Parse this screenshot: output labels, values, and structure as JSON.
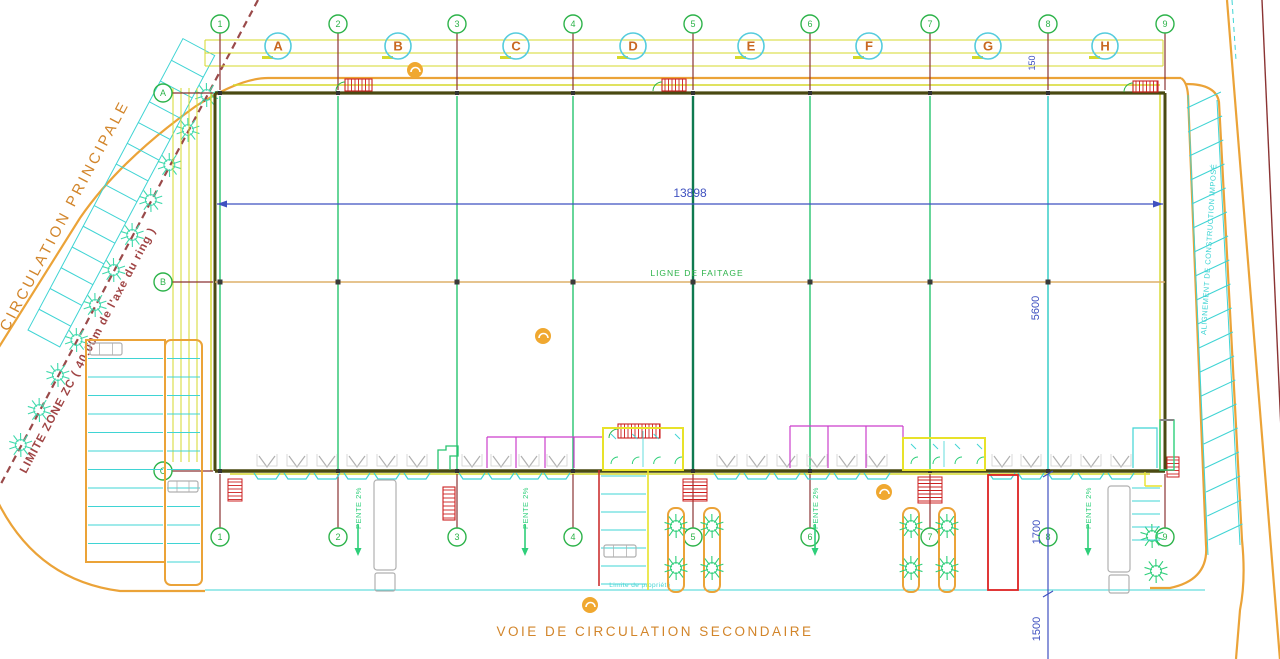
{
  "drawing": {
    "kind": "architectural-site-plan",
    "canvas": {
      "w": 1280,
      "h": 659
    }
  },
  "colors": {
    "green": "#2db34a",
    "col_green": "#27c46f",
    "col_dark": "#0f7a50",
    "cyan": "#3fd4d4",
    "cyan_circle": "#55ccdd",
    "teal_tree": "#3fd9ac",
    "green_tree": "#2ecf7a",
    "orange_road": "#eba338",
    "orange_text": "#d2852a",
    "orange_letter": "#c86820",
    "ridge": "#ddb06a",
    "yellow": "#d6d92b",
    "olive_wall": "#4a4a12",
    "maroon": "#9a4a4a",
    "dark_red": "#8a3333",
    "red": "#cc2020",
    "blue": "#3f51c0",
    "magenta": "#cc3fcc",
    "gray": "#b0b0b0",
    "orange_symbol": "#f0a830"
  },
  "grid": {
    "columns": [
      {
        "n": "1",
        "x": 220
      },
      {
        "n": "2",
        "x": 338
      },
      {
        "n": "3",
        "x": 457
      },
      {
        "n": "4",
        "x": 573
      },
      {
        "n": "5",
        "x": 693
      },
      {
        "n": "6",
        "x": 810
      },
      {
        "n": "7",
        "x": 930
      },
      {
        "n": "8",
        "x": 1048
      },
      {
        "n": "9",
        "x": 1165
      }
    ],
    "top_bubble_y": 24,
    "bottom_bubble_y": 537,
    "letters": [
      {
        "l": "A",
        "x": 278
      },
      {
        "l": "B",
        "x": 398
      },
      {
        "l": "C",
        "x": 516
      },
      {
        "l": "D",
        "x": 633
      },
      {
        "l": "E",
        "x": 751
      },
      {
        "l": "F",
        "x": 869
      },
      {
        "l": "G",
        "x": 988
      },
      {
        "l": "H",
        "x": 1105
      }
    ],
    "letter_y": 46,
    "rows": [
      {
        "l": "A",
        "y": 93
      },
      {
        "l": "B",
        "y": 282
      },
      {
        "l": "C",
        "y": 471
      }
    ],
    "row_bubble_x": 163
  },
  "building": {
    "x1": 215,
    "y1": 93,
    "x2": 1165,
    "y2": 471,
    "ridge_y": 282
  },
  "dimensions": {
    "width": {
      "label": "13898",
      "y": 204,
      "lx": 690,
      "ly": 197
    },
    "v5600": {
      "label": "5600",
      "x": 1048,
      "lx": 1039,
      "ly": 308
    },
    "v150": {
      "label": "150",
      "lx": 1035,
      "ly": 63
    },
    "v1700": {
      "label": "1700",
      "lx": 1040,
      "ly": 532,
      "y1": 474,
      "y2": 594
    },
    "v1500": {
      "label": "1500",
      "lx": 1040,
      "ly": 629,
      "y1": 594,
      "y2": 662
    }
  },
  "texts": {
    "ridge": "LIGNE DE FAITAGE",
    "road_secondary": "VOIE DE CIRCULATION SECONDAIRE",
    "road_principal": "CIRCULATION PRINCIPALE",
    "limite_zone": "LIMITE ZONE ZC ( 40.00m de l'axe du ring )",
    "alignement": "ALIGNEMENT DE CONSTRUCTION IMPOSÉ",
    "limite_propriete": "Limite de propriété",
    "pente": "PENTE 2%"
  },
  "pente_arrows": [
    {
      "x": 358
    },
    {
      "x": 525
    },
    {
      "x": 815
    },
    {
      "x": 1088
    }
  ],
  "docks": [
    267,
    297,
    327,
    357,
    387,
    417,
    472,
    501,
    529,
    557,
    727,
    757,
    787,
    817,
    847,
    877,
    1002,
    1031,
    1061,
    1091,
    1121
  ],
  "stairs_h": [
    {
      "x": 228,
      "y": 479,
      "w": 14,
      "h": 22
    },
    {
      "x": 683,
      "y": 479,
      "w": 24,
      "h": 22
    },
    {
      "x": 918,
      "y": 477,
      "w": 24,
      "h": 26
    },
    {
      "x": 1167,
      "y": 457,
      "w": 12,
      "h": 20
    }
  ],
  "doors_hatched": [
    {
      "x": 345,
      "y": 79,
      "w": 27,
      "h": 12
    },
    {
      "x": 662,
      "y": 79,
      "w": 24,
      "h": 12
    },
    {
      "x": 1133,
      "y": 81,
      "w": 25,
      "h": 11
    },
    {
      "x": 618,
      "y": 424,
      "w": 42,
      "h": 14
    },
    {
      "x": 443,
      "y": 487,
      "w": 12,
      "h": 33
    }
  ],
  "canopy": {
    "x": 988,
    "y": 475,
    "w": 30,
    "h": 115
  },
  "entrances": [
    {
      "x": 603,
      "y": 428,
      "w": 80,
      "h": 42
    },
    {
      "x": 903,
      "y": 438,
      "w": 82,
      "h": 32
    }
  ],
  "magenta_rooms": [
    {
      "xs": [
        487,
        516,
        545,
        574,
        603
      ],
      "top": 437,
      "bottom": 468
    },
    {
      "xs": [
        790,
        828,
        866,
        903
      ],
      "top": 426,
      "bottom": 468
    }
  ],
  "trucks": [
    {
      "x": 374,
      "y": 480,
      "w": 22,
      "h": 90,
      "cab": 18
    },
    {
      "x": 1108,
      "y": 486,
      "w": 22,
      "h": 86,
      "cab": 18
    }
  ],
  "cars": [
    {
      "x": 90,
      "y": 343,
      "w": 32,
      "h": 12
    },
    {
      "x": 168,
      "y": 481,
      "w": 30,
      "h": 11
    },
    {
      "x": 604,
      "y": 545,
      "w": 32,
      "h": 12
    }
  ],
  "planters": [
    {
      "cx": 676
    },
    {
      "cx": 712
    },
    {
      "cx": 911
    },
    {
      "cx": 947
    }
  ],
  "trees_bottom": [
    {
      "x": 676,
      "y": 526
    },
    {
      "x": 712,
      "y": 526
    },
    {
      "x": 676,
      "y": 568
    },
    {
      "x": 712,
      "y": 568
    },
    {
      "x": 911,
      "y": 526
    },
    {
      "x": 947,
      "y": 526
    },
    {
      "x": 911,
      "y": 568
    },
    {
      "x": 947,
      "y": 568
    },
    {
      "x": 1152,
      "y": 536
    },
    {
      "x": 1156,
      "y": 571
    }
  ],
  "trees_left_y": [
    95,
    130,
    165,
    200,
    235,
    270,
    305,
    340,
    375,
    410,
    445
  ],
  "orange_symbols": [
    {
      "x": 415,
      "y": 70
    },
    {
      "x": 543,
      "y": 336
    },
    {
      "x": 884,
      "y": 492
    },
    {
      "x": 590,
      "y": 605
    }
  ],
  "parking_left": {
    "strip1": {
      "x": 86,
      "y": 340,
      "w": 79,
      "h": 222
    },
    "strip2": {
      "x": 165,
      "y": 340,
      "w": 37,
      "h": 245
    },
    "stall_step": 18.5
  },
  "mini_parking": {
    "x_red": 599,
    "x_yellow": 648,
    "y1": 470,
    "y2": 586
  }
}
